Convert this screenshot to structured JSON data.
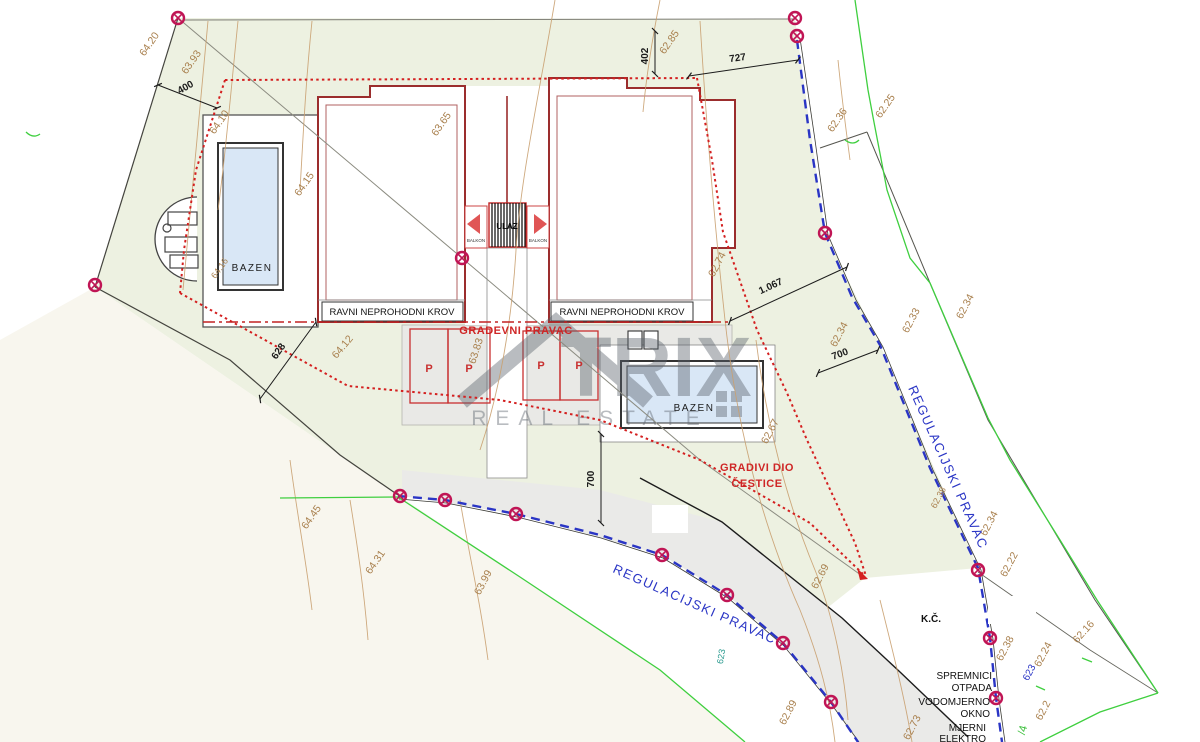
{
  "document": {
    "type": "architectural site plan"
  },
  "watermark": {
    "brand": "TRIX",
    "tagline": "REAL ESTATE"
  },
  "buildings": {
    "roof_label_left": "RAVNI NEPROHODNI KROV",
    "roof_label_right": "RAVNI NEPROHODNI KROV",
    "balcony_left": "BALKON",
    "balcony_right": "BALKON",
    "entrance": "ULAZ",
    "parking_stall": "P"
  },
  "pools": {
    "left": "BAZEN",
    "right": "BAZEN"
  },
  "lines": {
    "building_line": "GRADEVNI PRAVAC",
    "buildable_area_line1": "GRADIVI DIO",
    "buildable_area_line2": "ČESTICE",
    "regulation_bottom": "REGULACIJSKI PRAVAC",
    "regulation_right": "REGULACIJSKI PRAVAC"
  },
  "annotations": {
    "cadastral": "K.Č.",
    "waste_1": "SPREMNICI",
    "waste_2": "OTPADA",
    "water_1": "VODOMJERNO",
    "water_2": "OKNO",
    "electric_1": "MJERNI",
    "electric_2": "ELEKTRO",
    "parcel_number_blue": "623",
    "parcel_number_teal": "623",
    "parcel_fragment_green": "/4"
  },
  "dimensions": {
    "top_left": "400",
    "top_vertical": "402",
    "top_right": "727",
    "to_regulation": "1.067",
    "right": "700",
    "bottom_vertical": "700",
    "diagonal": "628"
  },
  "elevations": [
    {
      "v": "64.20"
    },
    {
      "v": "63.93"
    },
    {
      "v": "64.10"
    },
    {
      "v": "64.15"
    },
    {
      "v": "63.65"
    },
    {
      "v": "64.16"
    },
    {
      "v": "64.12"
    },
    {
      "v": "63.83"
    },
    {
      "v": "62.85"
    },
    {
      "v": "62.36"
    },
    {
      "v": "62.25"
    },
    {
      "v": "62.33"
    },
    {
      "v": "62.34"
    },
    {
      "v": "62.34"
    },
    {
      "v": "62.74"
    },
    {
      "v": "62.67"
    },
    {
      "v": "62.34"
    },
    {
      "v": "62.22"
    },
    {
      "v": "62.38"
    },
    {
      "v": "62.69"
    },
    {
      "v": "62.89"
    },
    {
      "v": "62.73"
    },
    {
      "v": "62.16"
    },
    {
      "v": "62.24"
    },
    {
      "v": "62.2"
    },
    {
      "v": "62.38"
    },
    {
      "v": "64.45"
    },
    {
      "v": "64.31"
    },
    {
      "v": "63.99"
    }
  ],
  "colors": {
    "buildable_line_red": "#d42020",
    "regulation_line_blue": "#2a35c5",
    "parcel_green": "#3fcf3f",
    "contour_tan": "#c9a070",
    "survey_marker": "#c01555",
    "pool_fill": "#d9e7f6",
    "parcel_fill_sage": "#edf1e1",
    "parcel_fill_cream": "#f8f6ee",
    "road_fill": "#e9e9e6"
  }
}
